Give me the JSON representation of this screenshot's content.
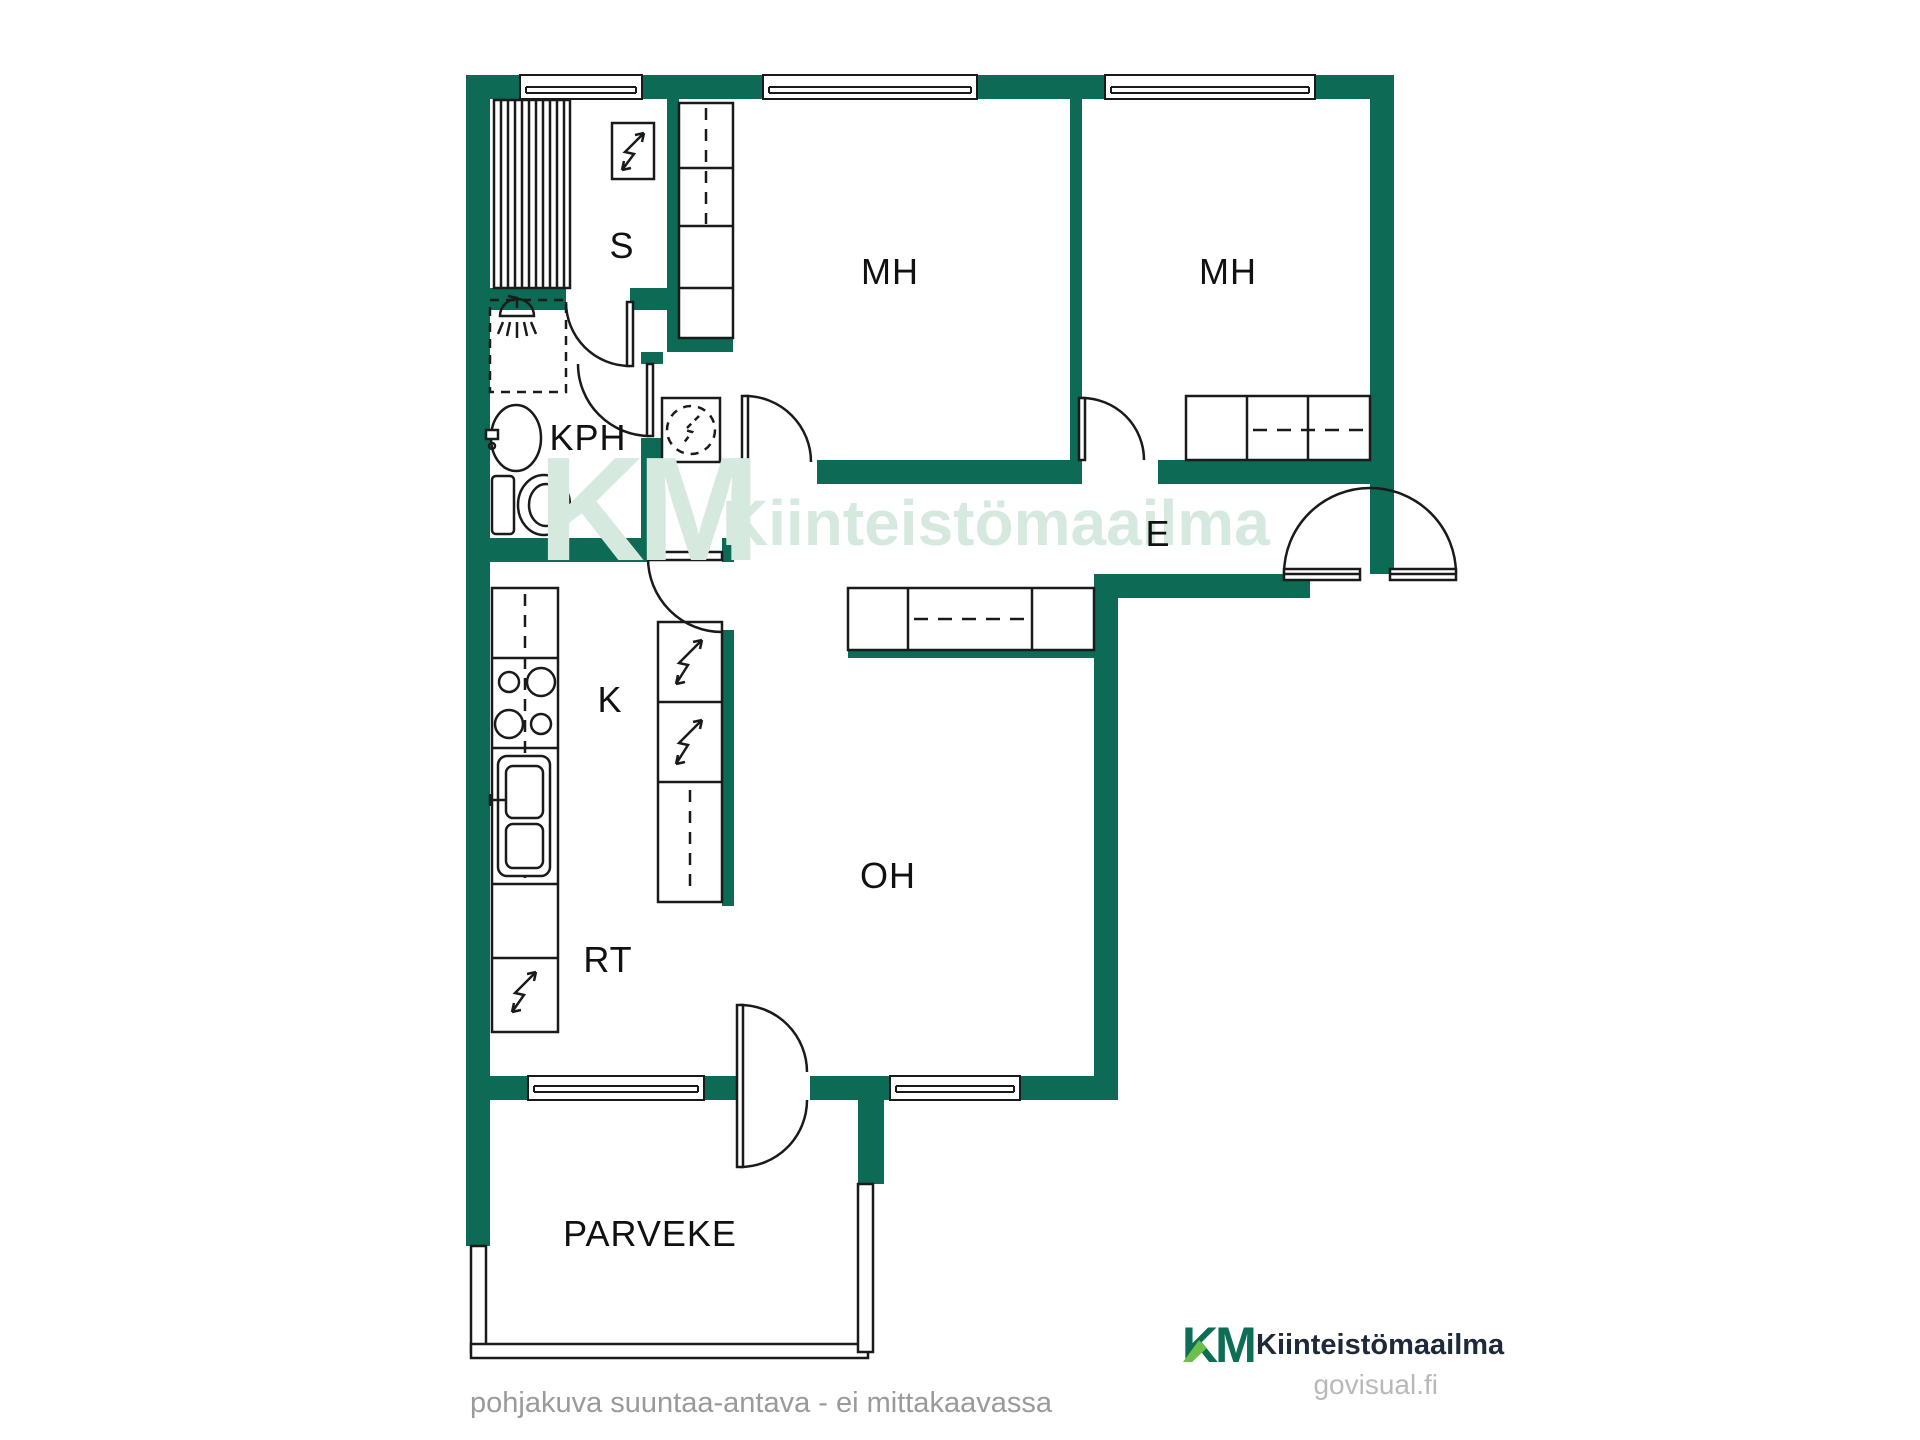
{
  "rooms": [
    {
      "id": "s",
      "label": "S"
    },
    {
      "id": "kph",
      "label": "KPH"
    },
    {
      "id": "mh1",
      "label": "MH"
    },
    {
      "id": "mh2",
      "label": "MH"
    },
    {
      "id": "e",
      "label": "E"
    },
    {
      "id": "k",
      "label": "K"
    },
    {
      "id": "oh",
      "label": "OH"
    },
    {
      "id": "rt",
      "label": "RT"
    },
    {
      "id": "parveke",
      "label": "PARVEKE"
    }
  ],
  "watermark": {
    "monogram": "KM",
    "text": "Kiinteistömaailma"
  },
  "branding": {
    "monogram": "KM",
    "name": "Kiinteistömaailma",
    "site": "govisual.fi"
  },
  "footer": {
    "disclaimer": "pohjakuva suuntaa-antava - ei mittakaavassa"
  },
  "colors": {
    "wall": "#0c6a55",
    "line": "#1a1a1a",
    "watermark": "#d6e9df",
    "logo_green": "#0e6e55",
    "logo_accent": "#6cbf4a",
    "logo_text": "#1e2a3a",
    "muted": "#9a9a9a",
    "site": "#b9b9b9"
  }
}
